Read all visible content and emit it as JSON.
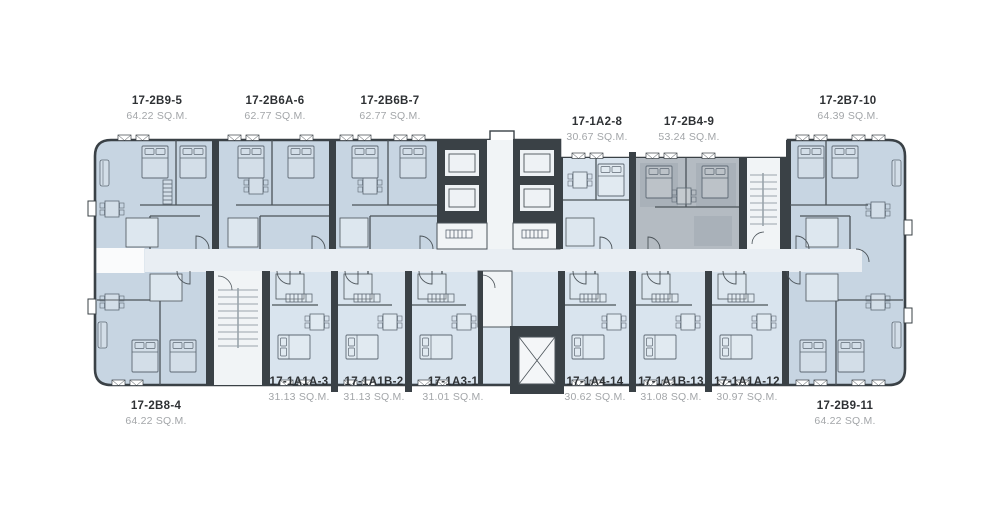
{
  "floorplan": {
    "title": "residential-tower-floor-plan-level-17",
    "units": [
      {
        "id": 0,
        "name": "17-2B9-5",
        "area": "64.22 SQ.M.",
        "row": "top",
        "highlighted": false
      },
      {
        "id": 1,
        "name": "17-2B6A-6",
        "area": "62.77 SQ.M.",
        "row": "top",
        "highlighted": false
      },
      {
        "id": 2,
        "name": "17-2B6B-7",
        "area": "62.77 SQ.M.",
        "row": "top",
        "highlighted": false
      },
      {
        "id": 3,
        "name": "17-1A2-8",
        "area": "30.67 SQ.M.",
        "row": "top",
        "highlighted": false
      },
      {
        "id": 4,
        "name": "17-2B4-9",
        "area": "53.24 SQ.M.",
        "row": "top",
        "highlighted": true
      },
      {
        "id": 5,
        "name": "17-2B7-10",
        "area": "64.39 SQ.M.",
        "row": "top",
        "highlighted": false
      },
      {
        "id": 6,
        "name": "17-2B8-4",
        "area": "64.22 SQ.M.",
        "row": "bottom",
        "highlighted": false
      },
      {
        "id": 7,
        "name": "17-1A1A-3",
        "area": "31.13 SQ.M.",
        "row": "bottom",
        "highlighted": false
      },
      {
        "id": 8,
        "name": "17-1A1B-2",
        "area": "31.13 SQ.M.",
        "row": "bottom",
        "highlighted": false
      },
      {
        "id": 9,
        "name": "17-1A3-1",
        "area": "31.01 SQ.M.",
        "row": "bottom",
        "highlighted": false
      },
      {
        "id": 10,
        "name": "17-1A4-14",
        "area": "30.62 SQ.M.",
        "row": "bottom",
        "highlighted": false
      },
      {
        "id": 11,
        "name": "17-1A1B-13",
        "area": "31.08 SQ.M.",
        "row": "bottom",
        "highlighted": false
      },
      {
        "id": 12,
        "name": "17-1A1A-12",
        "area": "30.97 SQ.M.",
        "row": "bottom",
        "highlighted": false
      },
      {
        "id": 13,
        "name": "17-2B9-11",
        "area": "64.22 SQ.M.",
        "row": "bottom",
        "highlighted": false
      }
    ],
    "colors": {
      "unit_fill": "#c7d5e2",
      "unit_fill_light": "#d9e4ee",
      "highlight_fill": "#b4bbc2",
      "highlight_room": "#a9b1b9",
      "wall": "#3a4146",
      "thin_wall": "#4b5359",
      "corridor": "#e9eef3",
      "stair": "#f1f4f6",
      "pod": "#dde7ef",
      "furniture": "#5d6873",
      "steps": "#9aa4ac",
      "label": "#2e3134",
      "area_label": "#a3a6a9"
    }
  }
}
